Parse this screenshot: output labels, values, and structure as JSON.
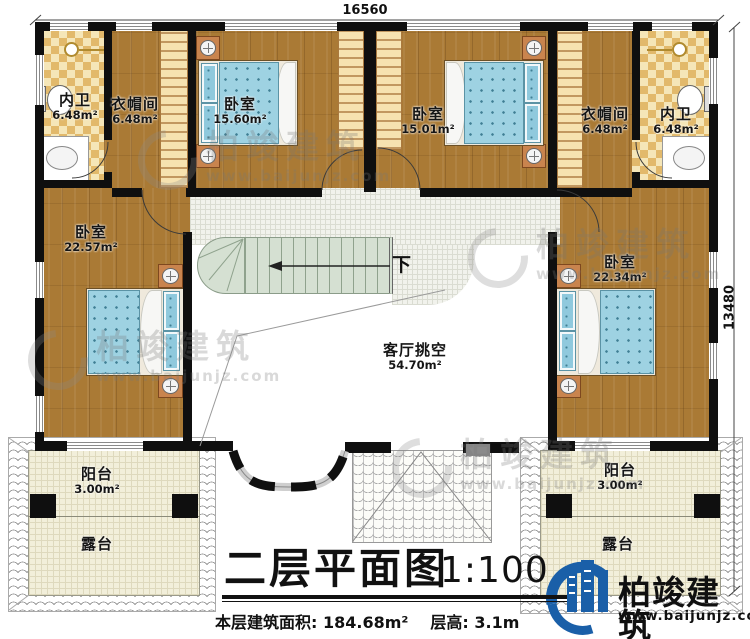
{
  "plan": {
    "dimension_top": "16560",
    "dimension_right": "13480",
    "stair_down": "下"
  },
  "rooms": {
    "bath_left": {
      "name": "内卫",
      "area": "6.48m²"
    },
    "cloak_left": {
      "name": "衣帽间",
      "area": "6.48m²"
    },
    "bedroom_top_left": {
      "name": "卧室",
      "area": "15.60m²"
    },
    "bedroom_top_right": {
      "name": "卧室",
      "area": "15.01m²"
    },
    "cloak_right": {
      "name": "衣帽间",
      "area": "6.48m²"
    },
    "bath_right": {
      "name": "内卫",
      "area": "6.48m²"
    },
    "bedroom_left": {
      "name": "卧室",
      "area": "22.57m²"
    },
    "bedroom_right": {
      "name": "卧室",
      "area": "22.34m²"
    },
    "living_void": {
      "name": "客厅挑空",
      "area": "54.70m²"
    },
    "balcony_left": {
      "name": "阳台",
      "area": "3.00m²"
    },
    "terrace_left": {
      "name": "露台"
    },
    "balcony_right": {
      "name": "阳台",
      "area": "3.00m²"
    },
    "terrace_right": {
      "name": "露台"
    }
  },
  "titleblock": {
    "title": "二层平面图",
    "scale": "1:100",
    "area_label": "本层建筑面积:",
    "area_value": "184.68m²",
    "floor_height_label": "层高:",
    "floor_height_value": "3.1m"
  },
  "brand": {
    "name": "柏竣建筑",
    "url": "www.baijunjz.com"
  },
  "watermark": {
    "name": "柏竣建筑",
    "url": "www.baijunjz.com"
  },
  "colors": {
    "wall": "#0f0f0f",
    "wood_floor": "#aa7a35",
    "tile_accent": "#e2b96b",
    "bed_blue": "#9ed2e2",
    "stair_green": "#d5e0d2",
    "terrace_cream": "#f2efda",
    "brand_blue": "#1a5fa8"
  }
}
